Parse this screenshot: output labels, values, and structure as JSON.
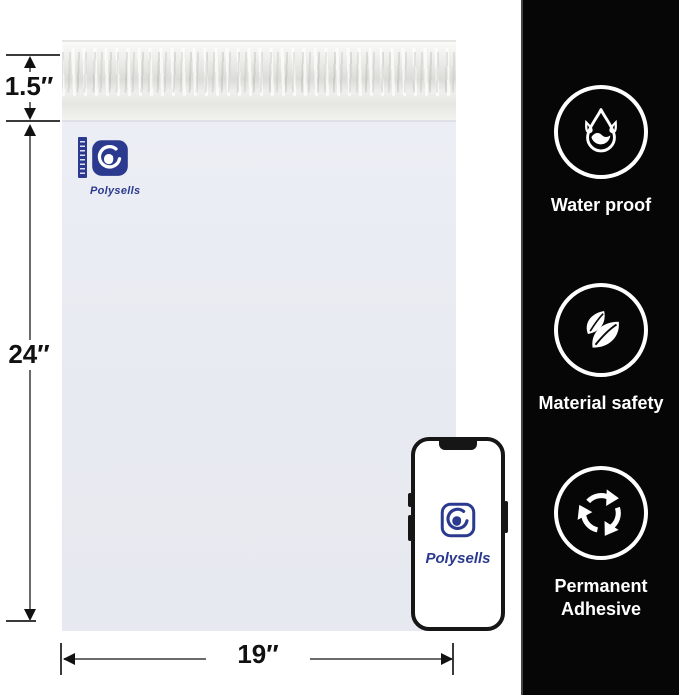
{
  "colors": {
    "brand_navy": "#2b3a8f",
    "sidebar_bg": "#060606",
    "bag_body": "#e9ebf2"
  },
  "brand": {
    "name": "Polysells"
  },
  "bag": {
    "logo_text": "Polysells"
  },
  "phone": {
    "logo_text": "Polysells"
  },
  "dimensions": {
    "flap_height_label": "1.5″",
    "bag_height_label": "24″",
    "bag_width_label": "19″"
  },
  "sidebar": {
    "features": [
      {
        "icon": "water-drop-icon",
        "label": "Water proof"
      },
      {
        "icon": "leaves-icon",
        "label": "Material safety"
      },
      {
        "icon": "recycle-arrows-icon",
        "label": "Permanent Adhesive"
      }
    ]
  }
}
